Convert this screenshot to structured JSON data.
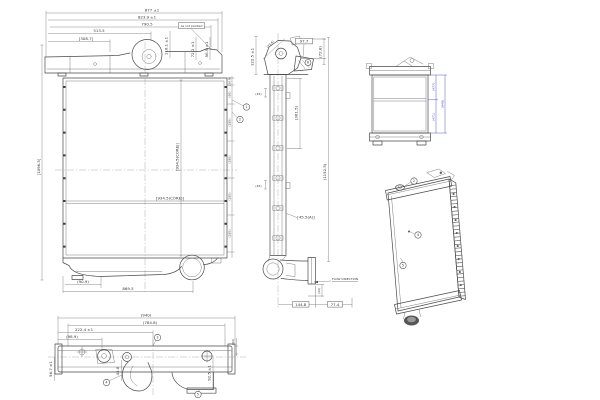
{
  "sheet": {
    "background": "#ffffff",
    "line_color": "#4a4a4a",
    "dimension_blue": "#4646c8"
  },
  "front_view": {
    "dims_width": [
      "877 ±1",
      "823.9 ±1",
      "790.5",
      "513.5",
      "[308.7]"
    ],
    "note_not_painted": "As not painted",
    "dims_tank_height": [
      "110.1 ±1",
      "72.2 ±1",
      "56.9 ±1"
    ],
    "dim_overall_height": "[1096.5]",
    "dim_core_height": "[934.5(CORE)]",
    "dim_core_height_label": "[934.5(CORE)]",
    "dims_right_chain": [
      "(36.9)",
      "(95)",
      "(185)",
      "(185)",
      "(185)",
      "(185)"
    ],
    "dim_bottom_offset": "(90.9)",
    "dim_bottom_width": "869.5",
    "callouts": [
      "1",
      "2"
    ]
  },
  "side_view": {
    "dim_bracket_height": "122.5 ±1",
    "dim_bracket_diagonal": "(73.6)",
    "dim_bracket_width": "97.7",
    "dim_bracket_offset": "(72.8)",
    "dim_upper_gap": "(45)",
    "dim_upper_span": "(361.5)",
    "dim_mid_gap": "(45)",
    "dim_overall_height": "(1152.5)",
    "dim_depth": "[45.5(A)]",
    "flow_direction_label": "FLOW DIRECTION",
    "dim_outlet_drop": "(44)",
    "dim_outlet_x": "144.8",
    "dim_outlet_y": "77.4",
    "callout": "6"
  },
  "bottom_view": {
    "dim_overall": "(940)",
    "dim_mounting_span": "(784.8)",
    "dim_filler_offset": "222.4 ±1",
    "dim_bracket_offset": "(98.9)",
    "dim_depth_left": "56.7 ±1",
    "dim_depth_center": "45.8",
    "dim_depth_right": "92.5 ±1",
    "dim_end_gap": "(44)",
    "callouts": [
      "3",
      "4",
      "5"
    ]
  },
  "rear_view": {
    "dim_upper_half": "(477)",
    "dim_total": "(948)",
    "dim_lower_half": "(471)"
  },
  "iso_view": {
    "callouts": [
      "2",
      "4",
      "5"
    ]
  }
}
